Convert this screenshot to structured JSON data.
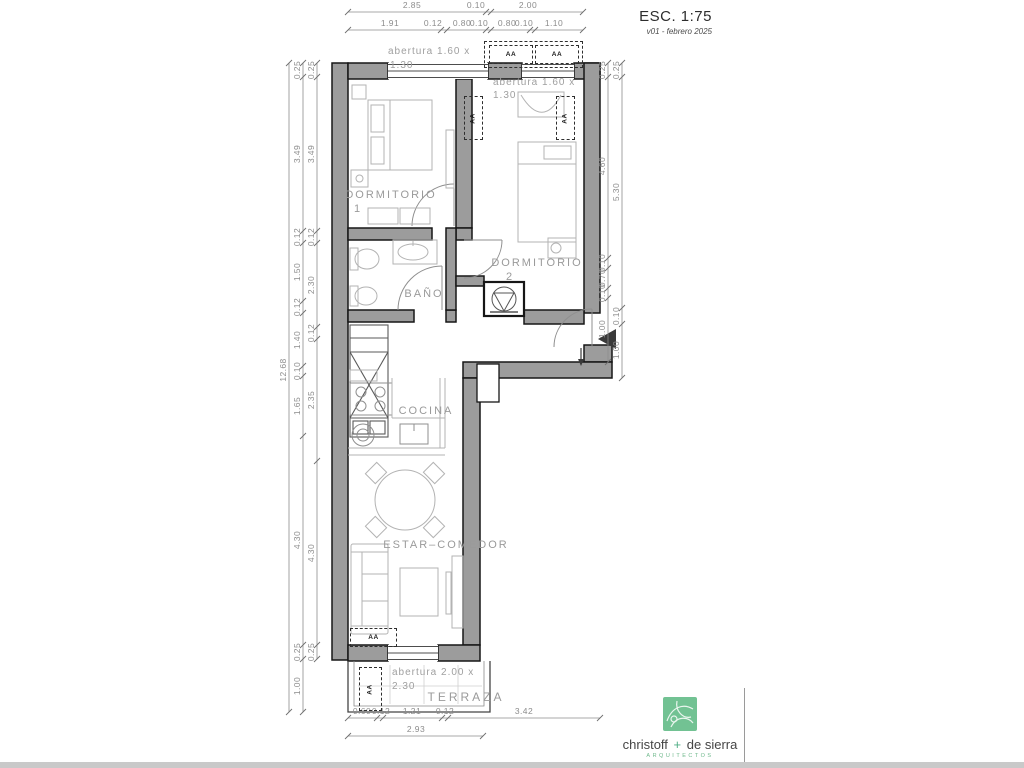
{
  "meta": {
    "scale_label": "ESC. 1:75",
    "version_label": "v01 - febrero 2025"
  },
  "logo": {
    "firm_left": "christoff",
    "firm_plus": "+",
    "firm_right": "de sierra",
    "subtitle": "ARQUITECTOS",
    "accent": "#72c293"
  },
  "rooms": {
    "dormitorio1": {
      "label": "DORMITORIO",
      "number": "1"
    },
    "dormitorio2": {
      "label": "DORMITORIO",
      "number": "2"
    },
    "bano": {
      "label": "BAÑO"
    },
    "cocina": {
      "label": "COCINA"
    },
    "estar": {
      "label": "ESTAR–COMEDOR"
    },
    "terraza": {
      "label": "TERRAZA"
    }
  },
  "openings": {
    "window1": {
      "line1": "abertura 1.60 x",
      "line2": "1.30"
    },
    "window2": {
      "line1": "abertura 1.60 x",
      "line2": "1.30"
    },
    "terraza_door": {
      "line1": "abertura 2.00 x",
      "line2": "2.30"
    }
  },
  "marker_label": "AA",
  "dimensions": {
    "top_row1": [
      "2.85",
      "0.10",
      "2.00"
    ],
    "top_row2": [
      "1.91",
      "0.12",
      "0.80",
      "0.10",
      "0.80",
      "0.10",
      "1.10"
    ],
    "left_total": [
      "12.68"
    ],
    "left_outer": [
      "0.25",
      "3.49",
      "0.12",
      "1.50",
      "0.12",
      "1.40",
      "0.10",
      "1.65",
      "4.30",
      "0.25",
      "1.00"
    ],
    "left_inner": [
      "0.25",
      "3.49",
      "0.12",
      "2.30",
      "0.12",
      "2.35",
      "4.30",
      "0.25"
    ],
    "right_inner": [
      "0.25",
      "4.60",
      "0.10",
      "0.70",
      "0.10",
      "1.00"
    ],
    "right_outer": [
      "0.25",
      "5.30",
      "0.10",
      "1.00"
    ],
    "bottom_row1": [
      "0.60",
      "0.12",
      "1.21",
      "0.12",
      "3.42"
    ],
    "bottom_row2": [
      "2.93"
    ]
  },
  "colors": {
    "wall_fill": "#9c9c9c",
    "wall_stroke": "#161616",
    "dimension": "#8c8c8c",
    "furniture": "#b3b3b3"
  }
}
